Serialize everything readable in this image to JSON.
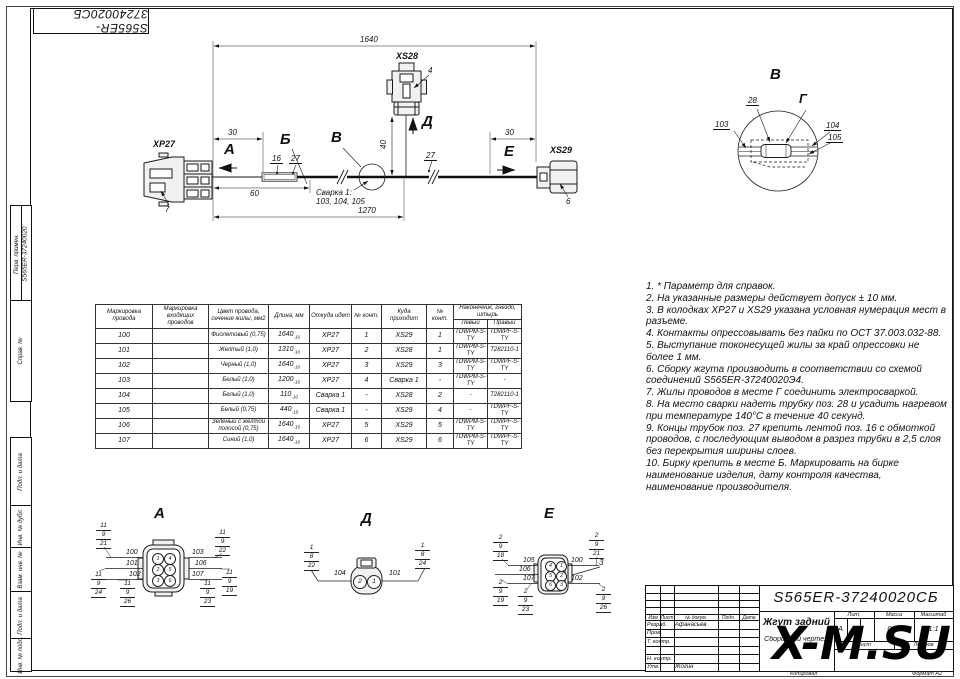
{
  "page": {
    "stamp_top": "S565ER-37240020СБ",
    "watermark": "X-M.SU",
    "copied_label": "Копировал",
    "format_label": "Формат А2"
  },
  "side": {
    "perv": "Перв. примен.",
    "perv_value": "S565ER-37240020",
    "sprav": "Справ. №",
    "podp1": "Подп. и дата",
    "inv_dubl": "Инв. № дубл.",
    "vzam": "Взам. инв. №",
    "podp2": "Подп. и дата",
    "inv_podl": "Инв. № подл."
  },
  "schematic": {
    "xp27": "XP27",
    "xs28": "XS28",
    "xs29": "XS29",
    "pos7": "7",
    "pos4": "4",
    "pos6": "6",
    "dim_1640": "1640",
    "dim_30l": "30",
    "dim_30r": "30",
    "dim_60": "60",
    "dim_1270": "1270",
    "dim_40": "40",
    "pos16": "16",
    "pos27a": "27",
    "pos27b": "27",
    "view_a": "А",
    "view_b": "Б",
    "view_v": "В",
    "view_d": "Д",
    "view_e": "Е",
    "weld_line1": "Сварка 1:",
    "weld_line2": "103, 104, 105"
  },
  "detail_v": {
    "title": "В",
    "g": "Г",
    "pos28": "28",
    "w103": "103",
    "w104": "104",
    "w105": "105"
  },
  "table": {
    "h_marking": "Маркировка провода",
    "h_incoming": "Маркировка входящих проводов",
    "h_color": "Цвет провода, сечение жилы, мм2",
    "h_length": "Длина, мм",
    "h_from": "Откуда идет",
    "h_cont1": "№ конт.",
    "h_to": "Куда приходит",
    "h_cont2": "№ конт.",
    "h_tip": "Наконечник, гнездо, штырь",
    "h_left": "Левый",
    "h_right": "Правый",
    "rows": [
      {
        "m": "100",
        "in": "",
        "color": "Фиолетовый (0,75)",
        "len": "1640",
        "tol": "-10",
        "from": "XP27",
        "c1": "1",
        "to": "XS29",
        "c2": "1",
        "tl": "TDWPM-S-TY",
        "tr": "TDWPF-S-TY"
      },
      {
        "m": "101",
        "in": "",
        "color": "Желтый (1,0)",
        "len": "1310",
        "tol": "-10",
        "from": "XP27",
        "c1": "2",
        "to": "XS28",
        "c2": "1",
        "tl": "TDWPM-S-TY",
        "tr": "T282110-1"
      },
      {
        "m": "102",
        "in": "",
        "color": "Черный (1,0)",
        "len": "1640",
        "tol": "-10",
        "from": "XP27",
        "c1": "3",
        "to": "XS29",
        "c2": "3",
        "tl": "TDWPM-S-TY",
        "tr": "TDWPF-S-TY"
      },
      {
        "m": "103",
        "in": "",
        "color": "Белый (1,0)",
        "len": "1200",
        "tol": "-10",
        "from": "XP27",
        "c1": "4",
        "to": "Сварка 1",
        "c2": "-",
        "tl": "TDWPM-S-TY",
        "tr": "-"
      },
      {
        "m": "104",
        "in": "",
        "color": "Белый (1,0)",
        "len": "110",
        "tol": "-10",
        "from": "Сварка 1",
        "c1": "-",
        "to": "XS28",
        "c2": "2",
        "tl": "-",
        "tr": "T282110-1"
      },
      {
        "m": "105",
        "in": "",
        "color": "Белый (0,75)",
        "len": "440",
        "tol": "-10",
        "from": "Сварка 1",
        "c1": "-",
        "to": "XS29",
        "c2": "4",
        "tl": "-",
        "tr": "TDWPF-S-TY"
      },
      {
        "m": "106",
        "in": "",
        "color": "Зеленый с желтой полосой (0,75)",
        "len": "1640",
        "tol": "-10",
        "from": "XP27",
        "c1": "5",
        "to": "XS29",
        "c2": "5",
        "tl": "TDWPM-S-TY",
        "tr": "TDWPF-S-TY"
      },
      {
        "m": "107",
        "in": "",
        "color": "Синий (1,0)",
        "len": "1640",
        "tol": "-10",
        "from": "XP27",
        "c1": "6",
        "to": "XS29",
        "c2": "6",
        "tl": "TDWPM-S-TY",
        "tr": "TDWPF-S-TY"
      }
    ]
  },
  "notes": [
    "1.   * Параметр для справок.",
    "2.   На указанные размеры действует допуск ± 10 мм.",
    "3.   В колодках ХР27 и XS29 указана условная нумерация мест в разъеме.",
    "4.   Контакты опрессовывать без пайки по ОСТ 37.003.032-88.",
    "5.   Выступание токонесущей жилы за край опрессовки не более 1 мм.",
    "6.   Сборку жгута производить в соответствии со схемой соединений S565ER-37240020Э4.",
    "7.   Жилы проводов в месте Г соединить электросваркой.",
    "8.   На место сварки надеть трубку поз. 28 и усадить нагревом при температуре 140°С в течение 40 секунд.",
    "9.   Концы трубок поз. 27 крепить лентой поз. 16 с обмоткой проводов, с последующим выводом в разрез трубки в 2,5 слоя без перекрытия ширины слоев.",
    "10. Бирку крепить в месте Б. Маркировать на бирке наименование изделия, дату контроля качества, наименование производителя."
  ],
  "views": {
    "a": {
      "title": "А",
      "pins": [
        "1",
        "4",
        "2",
        "5",
        "3",
        "6"
      ],
      "wl": [
        "100",
        "101",
        "102"
      ],
      "wr": [
        "103",
        "106",
        "107"
      ],
      "stacks": {
        "tl": [
          "11",
          "9",
          "21"
        ],
        "tr": [
          "11",
          "9",
          "22"
        ],
        "bl": [
          "11",
          "9",
          "24"
        ],
        "bml": [
          "11",
          "9",
          "26"
        ],
        "bmr": [
          "11",
          "9",
          "23"
        ],
        "br": [
          "11",
          "9",
          "19"
        ]
      }
    },
    "d": {
      "title": "Д",
      "pins": [
        "2",
        "1"
      ],
      "wl": "104",
      "wr": "101",
      "stacks": {
        "l": [
          "1",
          "8",
          "22"
        ],
        "r": [
          "1",
          "8",
          "24"
        ]
      }
    },
    "e": {
      "title": "Е",
      "pins": [
        "4",
        "1",
        "5",
        "2",
        "6",
        "3"
      ],
      "wl": [
        "105",
        "106",
        "107"
      ],
      "wr": [
        "100",
        "102"
      ],
      "pos3": "3",
      "stacks": {
        "tl": [
          "2",
          "9",
          "18"
        ],
        "tr": [
          "2",
          "9",
          "21"
        ],
        "bl": [
          "2",
          "9",
          "19"
        ],
        "bm": [
          "2",
          "9",
          "23"
        ],
        "br": [
          "2",
          "9",
          "26"
        ]
      }
    }
  },
  "title_block": {
    "code": "S565ER-37240020СБ",
    "name": "Жгут задний",
    "doc_type": "Сборочный чертеж",
    "col_izm": "Изм",
    "col_list": "Лист",
    "col_doc": "№ докум.",
    "col_podp": "Подп.",
    "col_data": "Дата",
    "razrab_label": "Разраб.",
    "razrab": "Афанасьев",
    "prov_label": "Пров.",
    "tkontr_label": "Т. контр.",
    "nkontr_label": "Н. контр.",
    "utv_label": "Утв.",
    "utv": "Жогин",
    "lit_label": "Лит.",
    "lit": "А",
    "massa_label": "Масса",
    "massa": "0,5*",
    "scale_label": "Масштаб",
    "scale": "1:1",
    "list_label": "Лист",
    "listov_label": "Листов"
  }
}
